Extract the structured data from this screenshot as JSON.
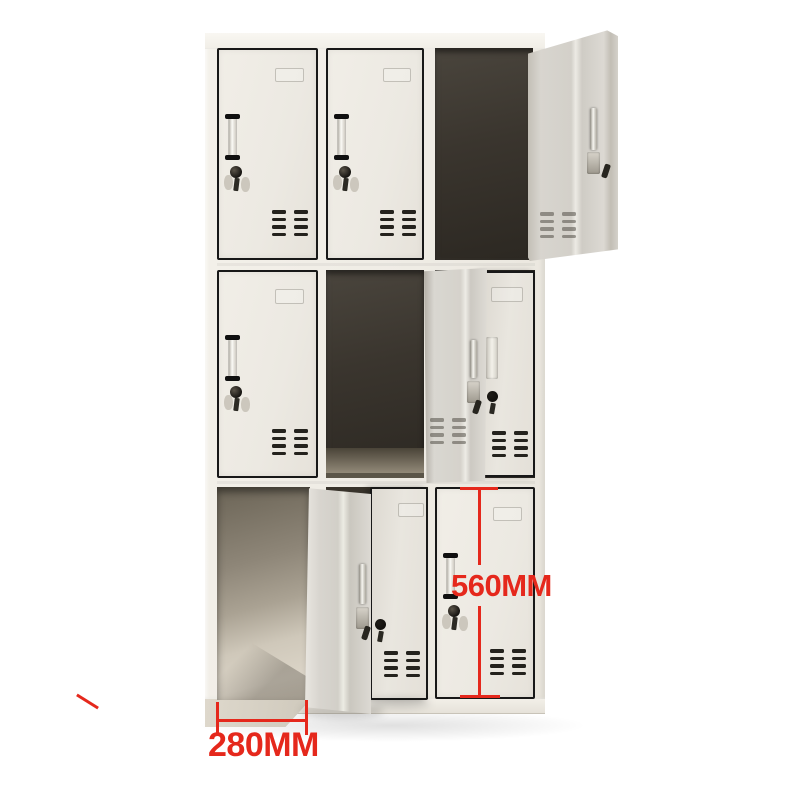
{
  "image": {
    "background_color": "#ffffff",
    "subject": "Nine-door grey-white steel locker cabinet, product photo",
    "description": "3x3 locker; top-right, middle-center and bottom-left doors open, middle-right and bottom-middle doors ajar, remaining doors closed with handles, key locks and ventilation slots"
  },
  "annotations": {
    "accent_color": "#e5281c",
    "door_height_label": "560MM",
    "compartment_width_label": "280MM"
  },
  "locker": {
    "rows": 3,
    "cols": 3,
    "door_color": "#edeae3",
    "outline_color": "#181818",
    "interior_dark_color": "#37322b",
    "open_panel_color": "#d8d5cf",
    "cells": [
      {
        "id": "r1c1",
        "state": "closed"
      },
      {
        "id": "r1c2",
        "state": "closed"
      },
      {
        "id": "r1c3",
        "state": "open"
      },
      {
        "id": "r2c1",
        "state": "closed"
      },
      {
        "id": "r2c2",
        "state": "open"
      },
      {
        "id": "r2c3",
        "state": "ajar"
      },
      {
        "id": "r3c1",
        "state": "open"
      },
      {
        "id": "r3c2",
        "state": "ajar"
      },
      {
        "id": "r3c3",
        "state": "closed"
      }
    ]
  }
}
